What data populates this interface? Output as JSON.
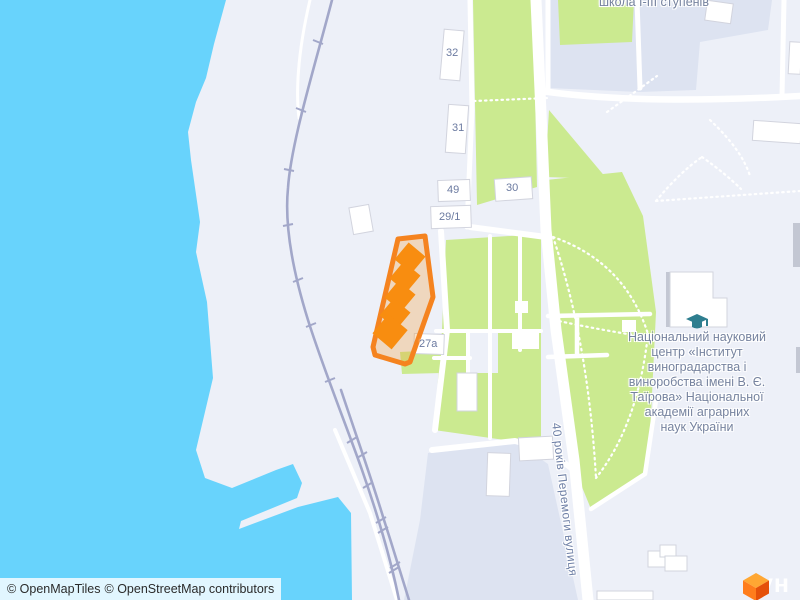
{
  "map": {
    "labels": {
      "school": "школа І-ІІІ ступенів",
      "institute": "Національний науковий\nцентр «Інститут\nвиноградарства і\nвиноробства імені В. Є.\nТаїрова» Національної\nакадемії аграрних\nнаук України",
      "street": "40 років Перемоги вулиця"
    },
    "buildings": [
      {
        "label": "32"
      },
      {
        "label": "31"
      },
      {
        "label": "49"
      },
      {
        "label": "29/1"
      },
      {
        "label": "30"
      },
      {
        "label": "27а"
      }
    ],
    "icons": {
      "institute_poi": "graduation-cap-icon"
    }
  },
  "attribution": {
    "openmaptiles": "© OpenMapTiles",
    "osm": "© OpenStreetMap contributors"
  },
  "logo": {
    "text": "лун"
  },
  "colors": {
    "water": "#68d3fc",
    "land": "#edf0f8",
    "land_secondary": "#dde3f1",
    "green": "#cbea90",
    "road": "#ffffff",
    "railway": "#a2a7c9",
    "building_fill": "#ffffff",
    "building_stroke": "#d2d4de",
    "building_shadow": "#c3c7d3",
    "highlight_stroke": "#f5831f",
    "highlight_fill": "rgba(245,150,40,0.28)",
    "highlight_building": "#f88d10",
    "label_text": "#76839f",
    "street_text": "#6f80a6",
    "number_text": "#6b7aa0",
    "poi_teal": "#2e7e8f",
    "logo_top": "#ffa733",
    "logo_left": "#ff7d1c",
    "logo_right": "#e5510a",
    "logo_text": "#ffffff",
    "attribution_bg": "rgba(255,255,255,0.8)",
    "attribution_text": "#2b2b2b"
  }
}
